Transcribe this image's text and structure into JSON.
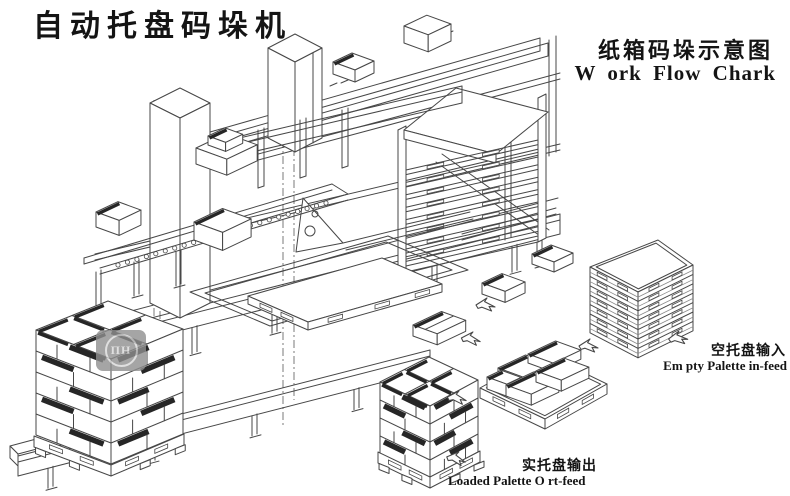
{
  "texts": {
    "title": "自动托盘码垛机",
    "subtitle_cn": "纸箱码垛示意图",
    "subtitle_en": "W ork Flow  Chark",
    "empty_pallet_cn": "空托盘输入",
    "empty_pallet_en": "Em pty Palette in-feed",
    "loaded_pallet_cn": "实托盘输出",
    "loaded_pallet_en": "Loaded Palette O rt-feed"
  },
  "watermark": {
    "text": "ПН"
  },
  "colors": {
    "background": "#ffffff",
    "line": "#474747",
    "dark": "#262626",
    "text": "#141414",
    "watermark_bg": "#8f8f8f",
    "watermark_fg": "#d8d8d8"
  },
  "diagram": {
    "components": [
      "carton-infeed-conveyor",
      "gantry-palletizer",
      "pallet-magazine",
      "lift-platform",
      "empty-pallet-stack",
      "single-layer-pallet",
      "loaded-pallet-stack",
      "outfeed-conveyor",
      "flow-arrows"
    ]
  }
}
